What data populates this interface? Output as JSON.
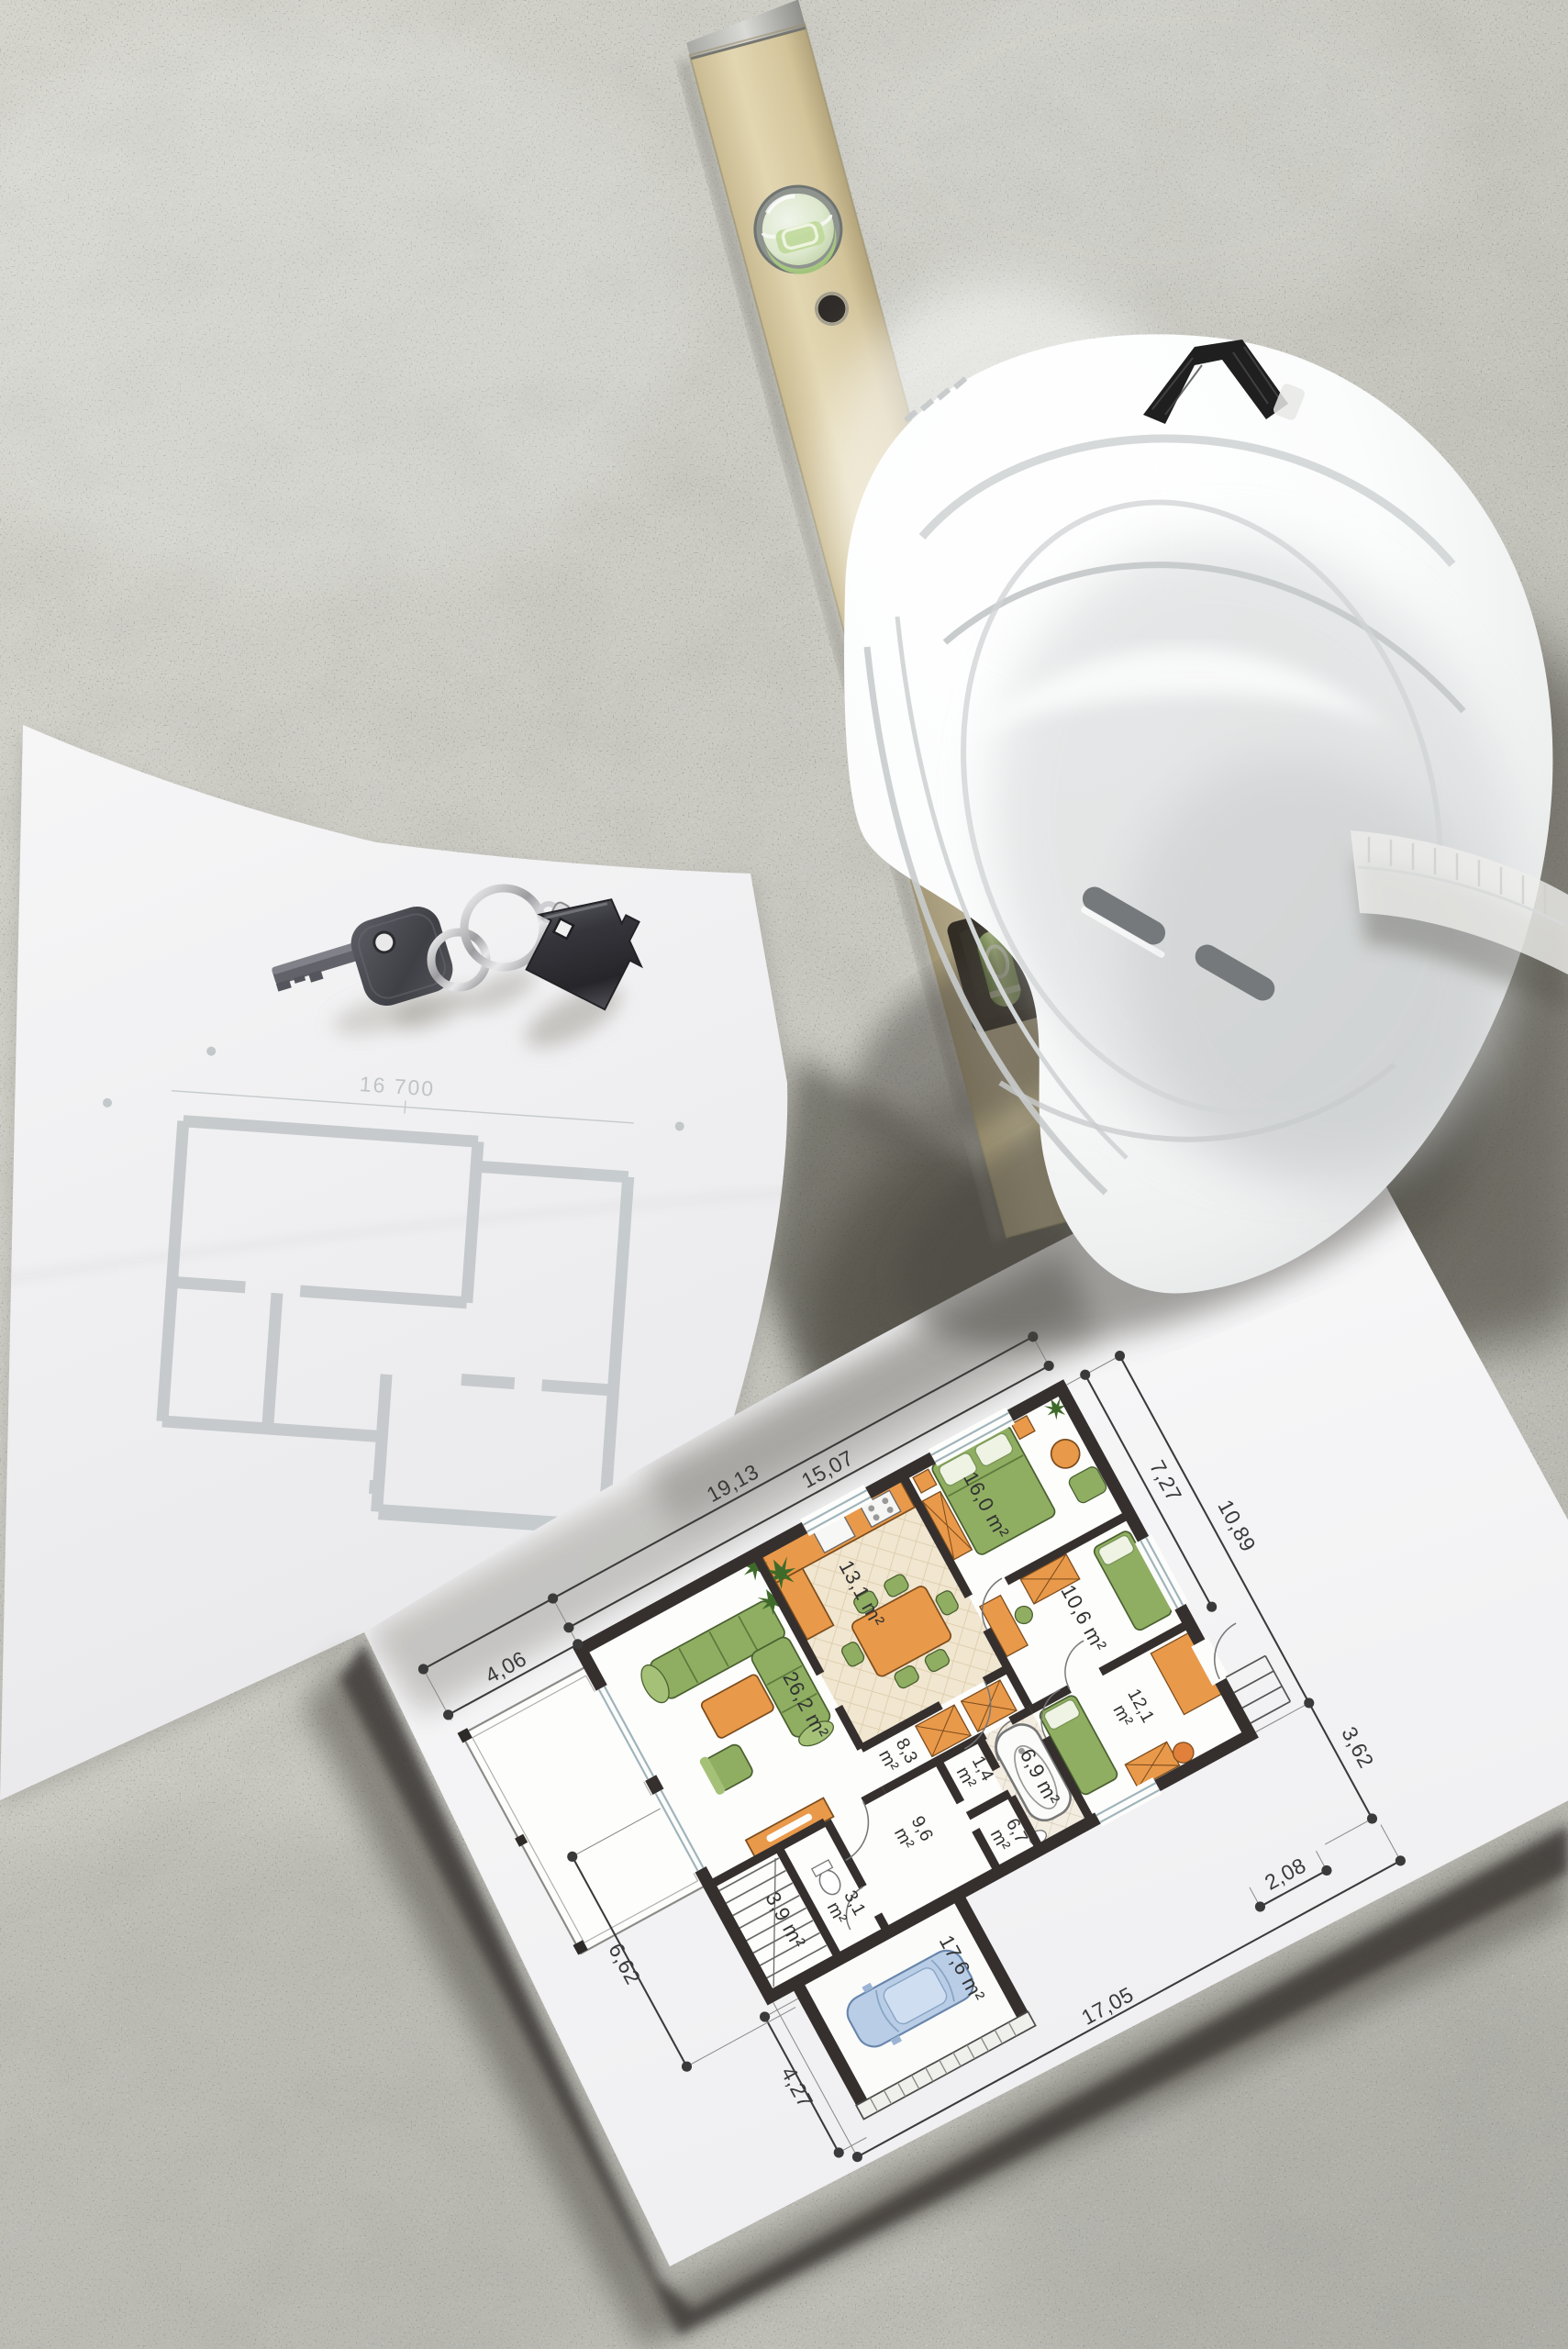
{
  "scene": {
    "type": "photograph",
    "subject": "Top-down flat lay of construction planning items on a concrete surface",
    "items": [
      "white hard hat",
      "wooden spirit level",
      "keys with house-shaped keychain",
      "faded floor plan sheet",
      "colored floor plan sheet"
    ],
    "colors": {
      "concrete": "#c7c6c0",
      "paper": "#f5f5f6",
      "level_body": "#d5c79e",
      "vial_green": "#a5cb7a",
      "hat": "#f4f5f5",
      "plan_wall": "#35302e",
      "furniture_orange": "#e9994a",
      "furniture_green": "#8fae62",
      "car_blue": "#b6cbe3"
    }
  },
  "faded_sheet": {
    "dimension_label": "16 700"
  },
  "plan_sheet": {
    "unit": "m²",
    "dimensions": {
      "top_outer": "19,13",
      "top_inner": "15,07",
      "top_left": "4,06",
      "right_upper": "7,27",
      "right_full": "10,89",
      "right_lower": "3,62",
      "bottom_right": "2,08",
      "left_middle": "6,62",
      "left_lower": "4,27",
      "bottom": "17,05"
    },
    "rooms": {
      "living": "26,2 m²",
      "kitchen": "13,1 m²",
      "bedroom_main": "16,0 m²",
      "bedroom_child": "10,6 m²",
      "closets": "8,3",
      "bedroom_right": "12,1",
      "hallway": "9,6",
      "wc": "3,1",
      "closet_small": "1,4",
      "bathroom": "6,9 m²",
      "utility": "6,7",
      "stairs_room": "3,9 m²",
      "garage": "17,6 m²"
    }
  }
}
